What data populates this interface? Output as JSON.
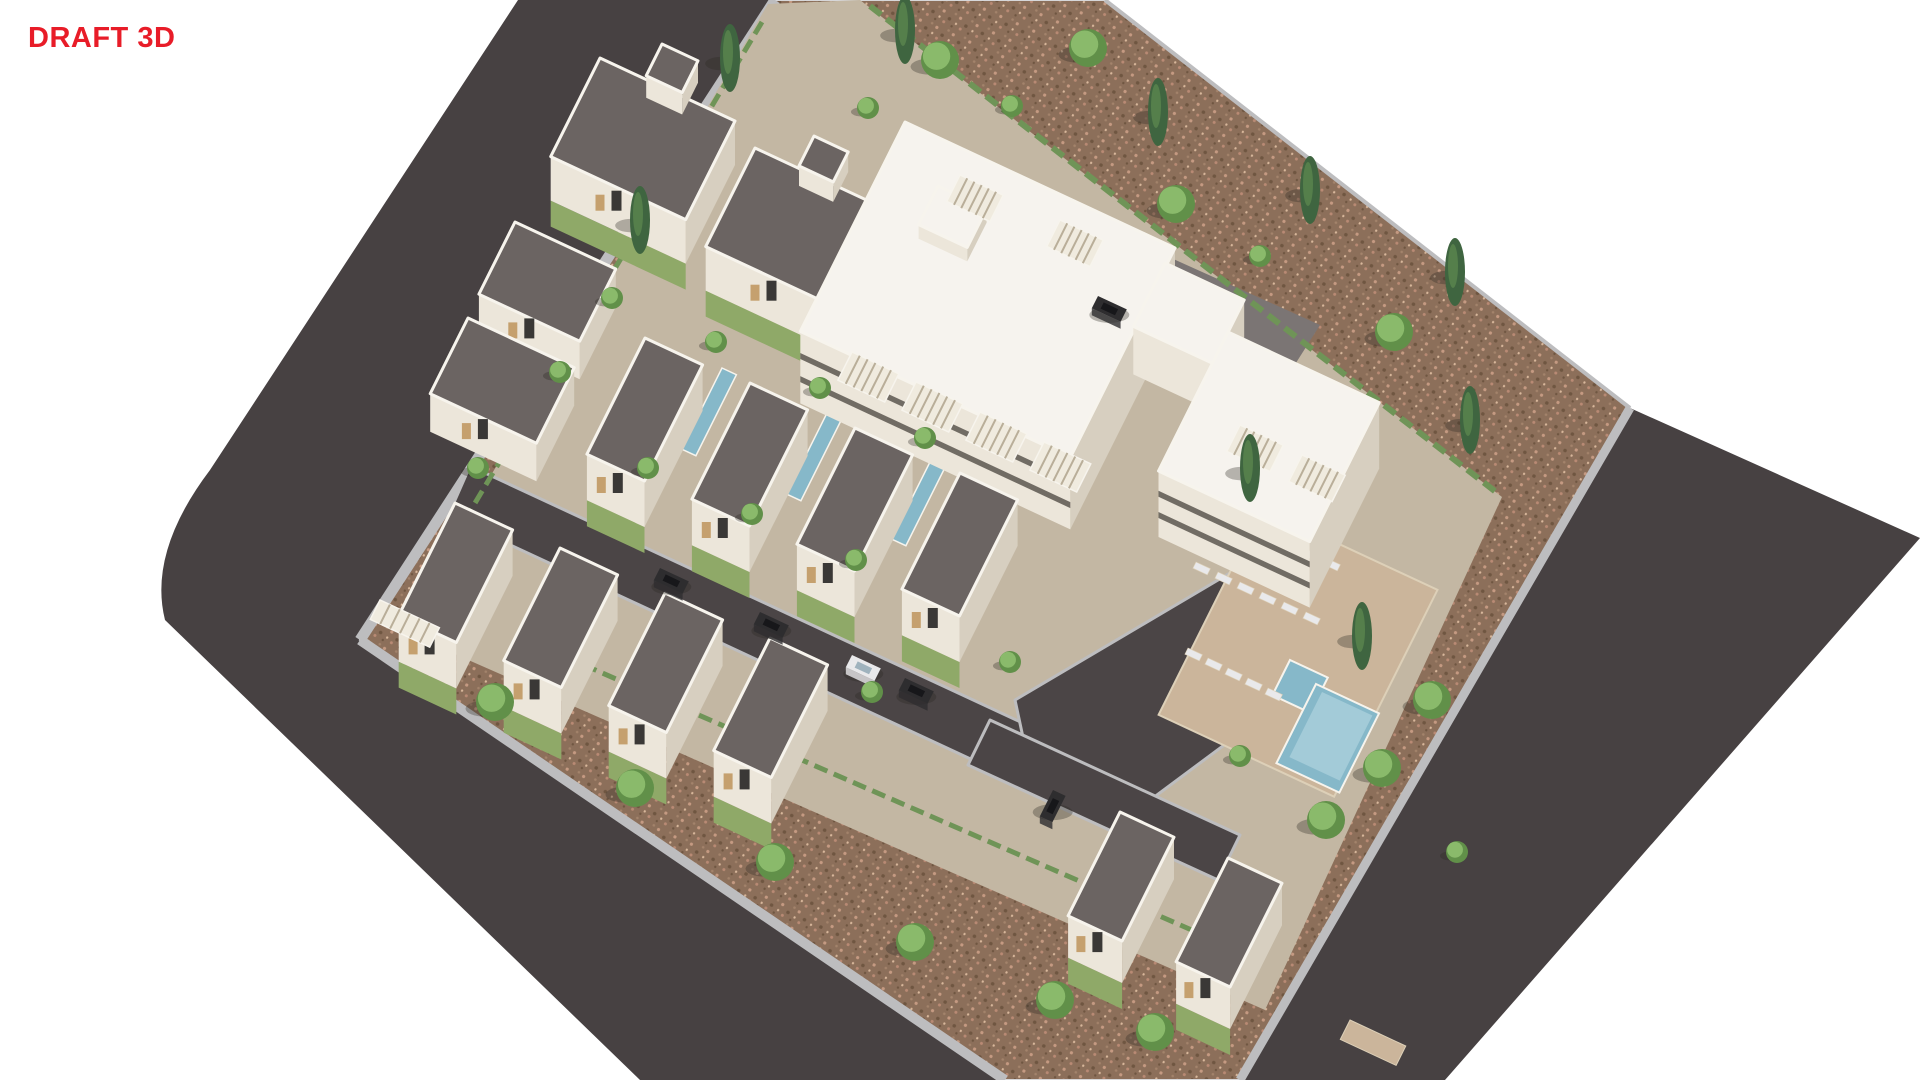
{
  "watermark": {
    "text": "DRAFT 3D"
  },
  "colors": {
    "bg": "#ffffff",
    "draft": "#e81c28",
    "road": "#474142",
    "street": "#4b4546",
    "court": "#7b7574",
    "sidewalk": "#bdbdbf",
    "curb": "#d7d7d9",
    "ground": "#8c6f5a",
    "speck1": "#c59a82",
    "speck2": "#6f5641",
    "speck3": "#b98a74",
    "speck4": "#a3836b",
    "speck5": "#d8b79b",
    "compound": "#c3b7a3",
    "grass": "#8fa968",
    "hedge": "#6f9457",
    "wall-lit": "#ece6da",
    "wall-shade": "#d7cfc0",
    "stone": "#bfa98c",
    "roof-dark": "#6b6462",
    "roof-white": "#f6f3ee",
    "parapet": "#f7f4ed",
    "band": "#5c564f",
    "glass": "#3a3836",
    "wood": "#c5a06e",
    "pergola-bg": "#f0ebdf",
    "pergola-slat": "#b9ae99",
    "deck": "#cbb59b",
    "deck-edge": "#ddd0b8",
    "pool": "#86b8c9",
    "pool-light": "#a3cbd8",
    "tree-base": "#619049",
    "tree-top": "#8aba6b",
    "cypress": "#3f6540",
    "car-dark": "#2e2d2f",
    "car-white": "#e9e9eb",
    "shadow": "rgba(45,40,34,0.32)"
  },
  "scene": {
    "roadPath": "M518,0 L1105,0 L1630,408 L1920,538 L1445,1080 L640,1080 L165,620 Q148,552 210,470 Z",
    "sitePoints": "775,0 1105,0 1630,408 1240,1080 1005,1080 360,640",
    "compoundPoints": "768,4 860,0 1502,497 1265,1010 400,630",
    "sidewalks": [
      {
        "name": "sidewalk-northwest",
        "pts": "775,0 360,640",
        "w": 11
      },
      {
        "name": "sidewalk-southwest",
        "pts": "360,640 1005,1080",
        "w": 10
      },
      {
        "name": "sidewalk-southeast",
        "pts": "1240,1080 1630,408",
        "w": 9
      },
      {
        "name": "wall-northeast",
        "pts": "1105,0 1630,408",
        "w": 4
      }
    ],
    "hedges": [
      {
        "name": "hedge-northeast-wall",
        "pts": "870,6 1496,492",
        "w": 6
      },
      {
        "name": "hedge-southwest-wall",
        "pts": "545,648 1210,938",
        "w": 5
      },
      {
        "name": "hedge-northwest-wall",
        "pts": "762,22 410,612",
        "w": 5
      }
    ],
    "streets": [
      {
        "name": "street-main",
        "pts": "470,466 1070,745 1048,795 448,516"
      },
      {
        "name": "street-entry-stub",
        "pts": "498,282 560,312 540,357 478,327"
      },
      {
        "name": "street-pool-loop",
        "pts": "1015,700 1235,570 1305,685 1130,815 1030,770"
      },
      {
        "name": "street-south",
        "pts": "990,720 1240,835 1218,880 968,765"
      }
    ],
    "courtyard": {
      "pts": "1120,235 1320,325 1256,426 1066,332"
    },
    "pavingPatch": {
      "n": [
        1350,
        1020
      ],
      "a": 62,
      "b": 22
    },
    "deck": {
      "n": [
        1262,
        508
      ],
      "a": 195,
      "b": 235
    },
    "mainPool": {
      "n": [
        1316,
        684
      ],
      "a": 70,
      "b": 90
    },
    "mainPoolInner": {
      "n": [
        1322,
        692
      ],
      "a": 56,
      "b": 74
    },
    "kidsPool": {
      "n": [
        1290,
        660
      ],
      "a": 42,
      "b": 40
    },
    "lapPools": [
      {
        "n": [
          722,
          368
        ],
        "a": 16,
        "b": 92
      },
      {
        "n": [
          827,
          413
        ],
        "a": 16,
        "b": 92
      },
      {
        "n": [
          932,
          458
        ],
        "a": 16,
        "b": 92
      }
    ],
    "loungers": [
      [
        1196,
        562
      ],
      [
        1218,
        572
      ],
      [
        1240,
        582
      ],
      [
        1262,
        592
      ],
      [
        1284,
        602
      ],
      [
        1306,
        612
      ],
      [
        1188,
        648
      ],
      [
        1208,
        658
      ],
      [
        1228,
        668
      ],
      [
        1248,
        678
      ],
      [
        1268,
        688
      ],
      [
        1282,
        538
      ],
      [
        1304,
        548
      ],
      [
        1326,
        558
      ]
    ],
    "boxes": [
      {
        "name": "villa-north-1",
        "n": [
          600,
          58
        ],
        "a": 150,
        "b": 112,
        "h": 44,
        "roof": "dark",
        "door": true,
        "grass": true,
        "tower": {
          "n": [
            662,
            44
          ],
          "a": 40,
          "b": 36,
          "h": 22,
          "roof": "dark"
        }
      },
      {
        "name": "garage-north",
        "n": [
          515,
          222
        ],
        "a": 112,
        "b": 82,
        "h": 38,
        "roof": "dark",
        "door": true
      },
      {
        "name": "villa-north-2",
        "n": [
          755,
          148
        ],
        "a": 150,
        "b": 112,
        "h": 44,
        "roof": "dark",
        "door": true,
        "grass": true,
        "tower": {
          "n": [
            814,
            136
          ],
          "a": 38,
          "b": 34,
          "h": 20,
          "roof": "dark"
        }
      },
      {
        "name": "apartment-block-a",
        "n": [
          905,
          122
        ],
        "a": 300,
        "b": 238,
        "h": 72,
        "roof": "white",
        "bands": true,
        "tower": {
          "n": [
            938,
            186
          ],
          "a": 54,
          "b": 44,
          "h": 14,
          "roof": "white"
        }
      },
      {
        "name": "garage-west",
        "n": [
          468,
          318
        ],
        "a": 118,
        "b": 86,
        "h": 38,
        "roof": "dark",
        "door": true
      },
      {
        "name": "villa-m1",
        "n": [
          645,
          338
        ],
        "a": 64,
        "b": 132,
        "h": 46,
        "roof": "dark",
        "door": true,
        "grass": true
      },
      {
        "name": "villa-m2",
        "n": [
          750,
          383
        ],
        "a": 64,
        "b": 132,
        "h": 46,
        "roof": "dark",
        "door": true,
        "grass": true
      },
      {
        "name": "annex-block",
        "n": [
          1165,
          263
        ],
        "a": 88,
        "b": 72,
        "h": 48,
        "roof": "white"
      },
      {
        "name": "villa-m3",
        "n": [
          855,
          428
        ],
        "a": 64,
        "b": 132,
        "h": 46,
        "roof": "dark",
        "door": true,
        "grass": true
      },
      {
        "name": "villa-r1",
        "n": [
          455,
          503
        ],
        "a": 64,
        "b": 128,
        "h": 46,
        "roof": "dark",
        "door": true,
        "grass": true
      },
      {
        "name": "villa-r2",
        "n": [
          560,
          548
        ],
        "a": 64,
        "b": 128,
        "h": 46,
        "roof": "dark",
        "door": true,
        "grass": true
      },
      {
        "name": "apartment-block-b",
        "n": [
          1228,
          332
        ],
        "a": 168,
        "b": 158,
        "h": 66,
        "roof": "white",
        "bands": true
      },
      {
        "name": "villa-m4",
        "n": [
          960,
          473
        ],
        "a": 64,
        "b": 132,
        "h": 46,
        "roof": "dark",
        "door": true,
        "grass": true
      },
      {
        "name": "villa-r3",
        "n": [
          665,
          593
        ],
        "a": 64,
        "b": 128,
        "h": 46,
        "roof": "dark",
        "door": true,
        "grass": true
      },
      {
        "name": "villa-r4",
        "n": [
          770,
          638
        ],
        "a": 64,
        "b": 128,
        "h": 46,
        "roof": "dark",
        "door": true,
        "grass": true
      },
      {
        "name": "villa-c1",
        "n": [
          1120,
          812
        ],
        "a": 60,
        "b": 118,
        "h": 42,
        "roof": "dark",
        "door": true,
        "grass": true
      },
      {
        "name": "villa-c2",
        "n": [
          1228,
          858
        ],
        "a": 60,
        "b": 118,
        "h": 42,
        "roof": "dark",
        "door": true,
        "grass": true
      }
    ],
    "pergolas": [
      {
        "n": [
          852,
          352
        ],
        "a": 52,
        "b": 32
      },
      {
        "n": [
          916,
          382
        ],
        "a": 52,
        "b": 32
      },
      {
        "n": [
          980,
          412
        ],
        "a": 52,
        "b": 32
      },
      {
        "n": [
          1044,
          442
        ],
        "a": 52,
        "b": 32
      },
      {
        "n": [
          960,
          175
        ],
        "a": 48,
        "b": 30
      },
      {
        "n": [
          1060,
          220
        ],
        "a": 48,
        "b": 30
      },
      {
        "n": [
          1240,
          425
        ],
        "a": 48,
        "b": 30
      },
      {
        "n": [
          1302,
          455
        ],
        "a": 48,
        "b": 30
      },
      {
        "n": [
          380,
          600
        ],
        "a": 66,
        "b": 22
      }
    ],
    "cars": [
      {
        "n": [
          660,
          568
        ],
        "c": "dark"
      },
      {
        "n": [
          760,
          612
        ],
        "c": "dark"
      },
      {
        "n": [
          852,
          655
        ],
        "c": "white"
      },
      {
        "n": [
          905,
          678
        ],
        "c": "dark"
      },
      {
        "n": [
          1053,
          790
        ],
        "c": "dark",
        "dir": "v"
      },
      {
        "n": [
          1098,
          296
        ],
        "c": "dark"
      }
    ],
    "trees": {
      "cypress": [
        [
          730,
          58
        ],
        [
          905,
          30
        ],
        [
          1158,
          112
        ],
        [
          1310,
          190
        ],
        [
          1455,
          272
        ],
        [
          640,
          220
        ],
        [
          1250,
          468
        ],
        [
          1362,
          636
        ],
        [
          1470,
          420
        ]
      ],
      "roundLarge": [
        [
          940,
          60
        ],
        [
          1088,
          48
        ],
        [
          1176,
          204
        ],
        [
          1394,
          332
        ],
        [
          495,
          702
        ],
        [
          635,
          788
        ],
        [
          775,
          862
        ],
        [
          915,
          942
        ],
        [
          1055,
          1000
        ],
        [
          1155,
          1032
        ],
        [
          1432,
          700
        ],
        [
          1382,
          768
        ],
        [
          1326,
          820
        ]
      ],
      "roundSmall": [
        [
          1012,
          106
        ],
        [
          1260,
          256
        ],
        [
          868,
          108
        ],
        [
          612,
          298
        ],
        [
          716,
          342
        ],
        [
          820,
          388
        ],
        [
          925,
          438
        ],
        [
          648,
          468
        ],
        [
          752,
          514
        ],
        [
          856,
          560
        ],
        [
          1010,
          662
        ],
        [
          872,
          692
        ],
        [
          1240,
          756
        ],
        [
          478,
          468
        ],
        [
          560,
          372
        ],
        [
          1457,
          852
        ]
      ]
    }
  }
}
